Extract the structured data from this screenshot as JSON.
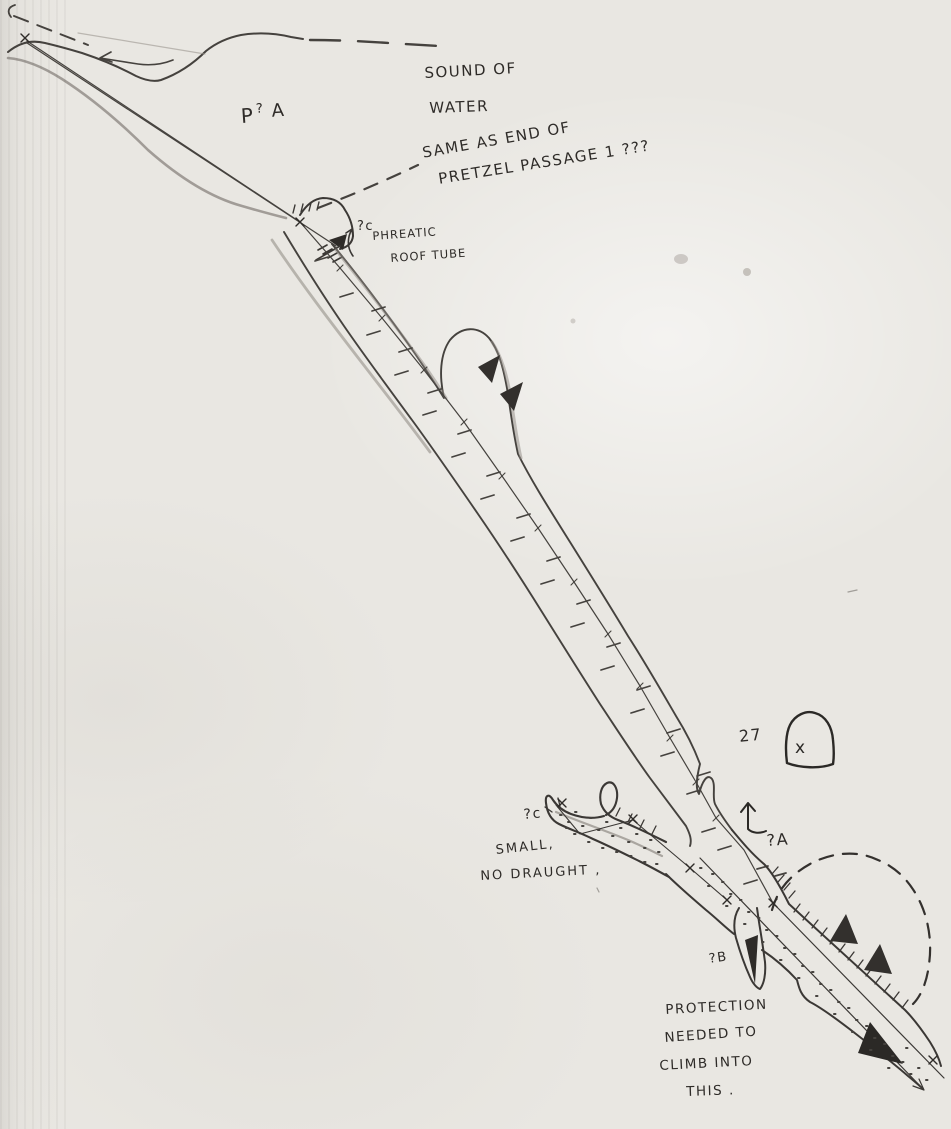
{
  "colors": {
    "paper": "#e9e7e2",
    "pencil": "#454240",
    "pencil_soft": "#9b968f",
    "ink": "#2b2926"
  },
  "annotations": {
    "surface_note_line1": "SOUND OF",
    "surface_note_line2": "WATER",
    "surface_note_line3": "SAME AS END OF",
    "surface_note_line4": "PRETZEL PASSAGE 1 ???",
    "p_query_a": {
      "p": "P",
      "q": "?",
      "a": "A"
    },
    "qc_upper": "?c",
    "phreatic_line1": "PHREATIC",
    "phreatic_line2": "ROOF TUBE",
    "qc_lower": "?c",
    "small_note_line1": "SMALL,",
    "small_note_line2": "NO DRAUGHT ,",
    "passage_27": "27",
    "section_x": "x",
    "qa": "?A",
    "qb": "?B",
    "protection_line1": "PROTECTION",
    "protection_line2": "NEEDED TO",
    "protection_line3": "CLIMB INTO",
    "protection_line4": "THIS ."
  }
}
